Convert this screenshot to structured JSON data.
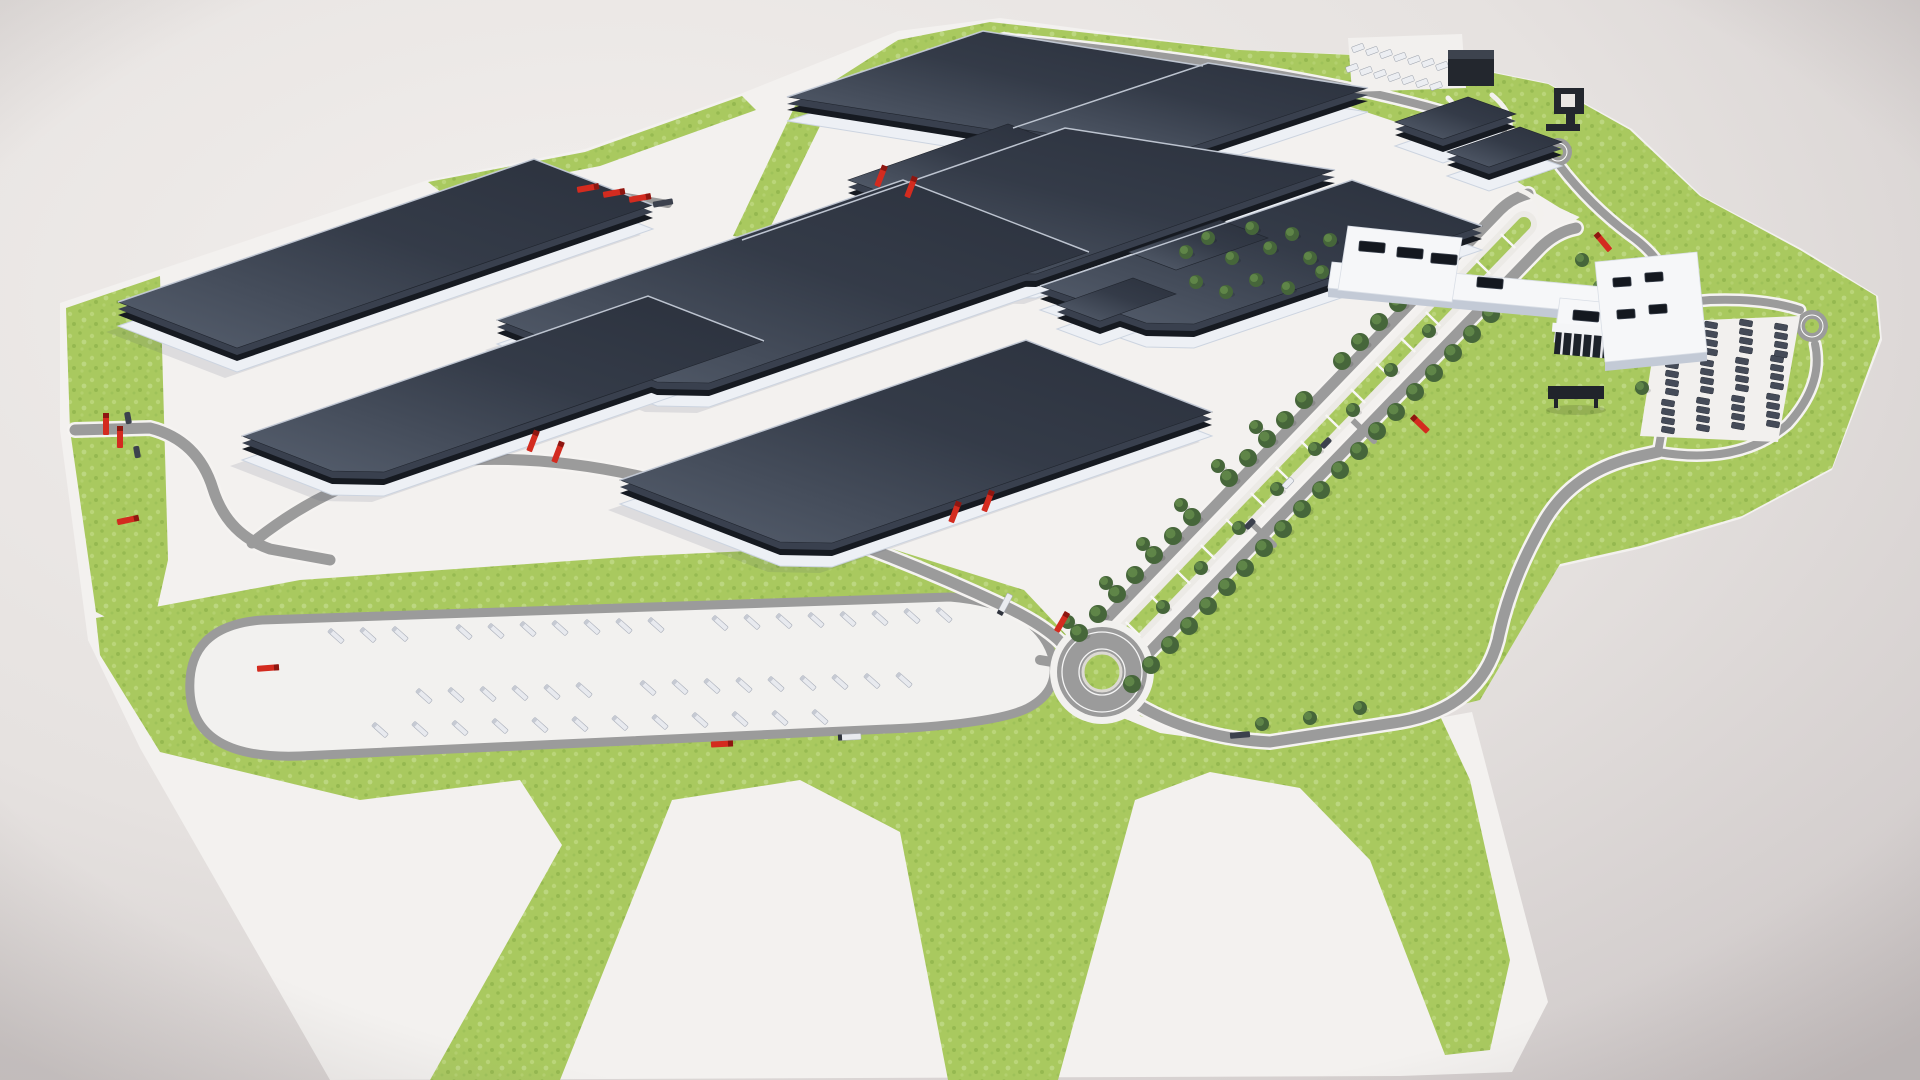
{
  "scene": {
    "description": "Aerial 3D architectural rendering of a large industrial factory campus: dark flat-roofed production halls on white grounds, landscaped lawns, a tree-lined boulevard, roundabouts, a truck trailer yard, car parks, a gatehouse and a pedestrian bridge, floating on a neutral studio backdrop",
    "render_style": "photorealistic CGI masterplan visualization",
    "view": "high-angle aerial oblique"
  },
  "colors": {
    "background_center": "#f2efed",
    "background_edge": "#cdc7c7",
    "site_ground": "#f3f1ef",
    "grass": "#a9c95f",
    "grass_light": "#c3dc8a",
    "grass_dark": "#8fb24a",
    "road": "#9b9b9b",
    "road_casing": "#f5f3f1",
    "road_marking": "#ffffff",
    "roof_light": "#57606f",
    "roof_dark": "#2b313d",
    "roof_tier": "#39404e",
    "dock_band": "#161a21",
    "building_base": "#edf0f5",
    "base_edge": "#ccd4e0",
    "white_building": "#f6f7f9",
    "white_building_shadow": "#c3cad6",
    "skylight": "#14181f",
    "tree_dark": "#46663a",
    "tree_light": "#5f8548",
    "truck_red": "#d32b1f",
    "trailer_white": "#e8eaef",
    "vehicle_dark": "#454b58",
    "structure_dark": "#23272e"
  },
  "site": {
    "factory_halls": 8,
    "secondary_halls": 5,
    "office_buildings": 2,
    "pedestrian_bridges": 1,
    "gatehouses": 1,
    "portal_structures": 1,
    "canopies": 1,
    "roundabouts": 3,
    "truck_yard": {
      "trailer_rows": 3,
      "trailers": 45,
      "standing_red_trucks": 1
    },
    "car_parking_lots": 2,
    "parked_dark_cars": 48,
    "parked_white_cars": 14,
    "boulevard": {
      "tree_rows": 4,
      "parking_bays": 16
    },
    "trees_total": 73,
    "red_trucks": 17,
    "white_trucks": 2,
    "dark_trucks": 2
  }
}
